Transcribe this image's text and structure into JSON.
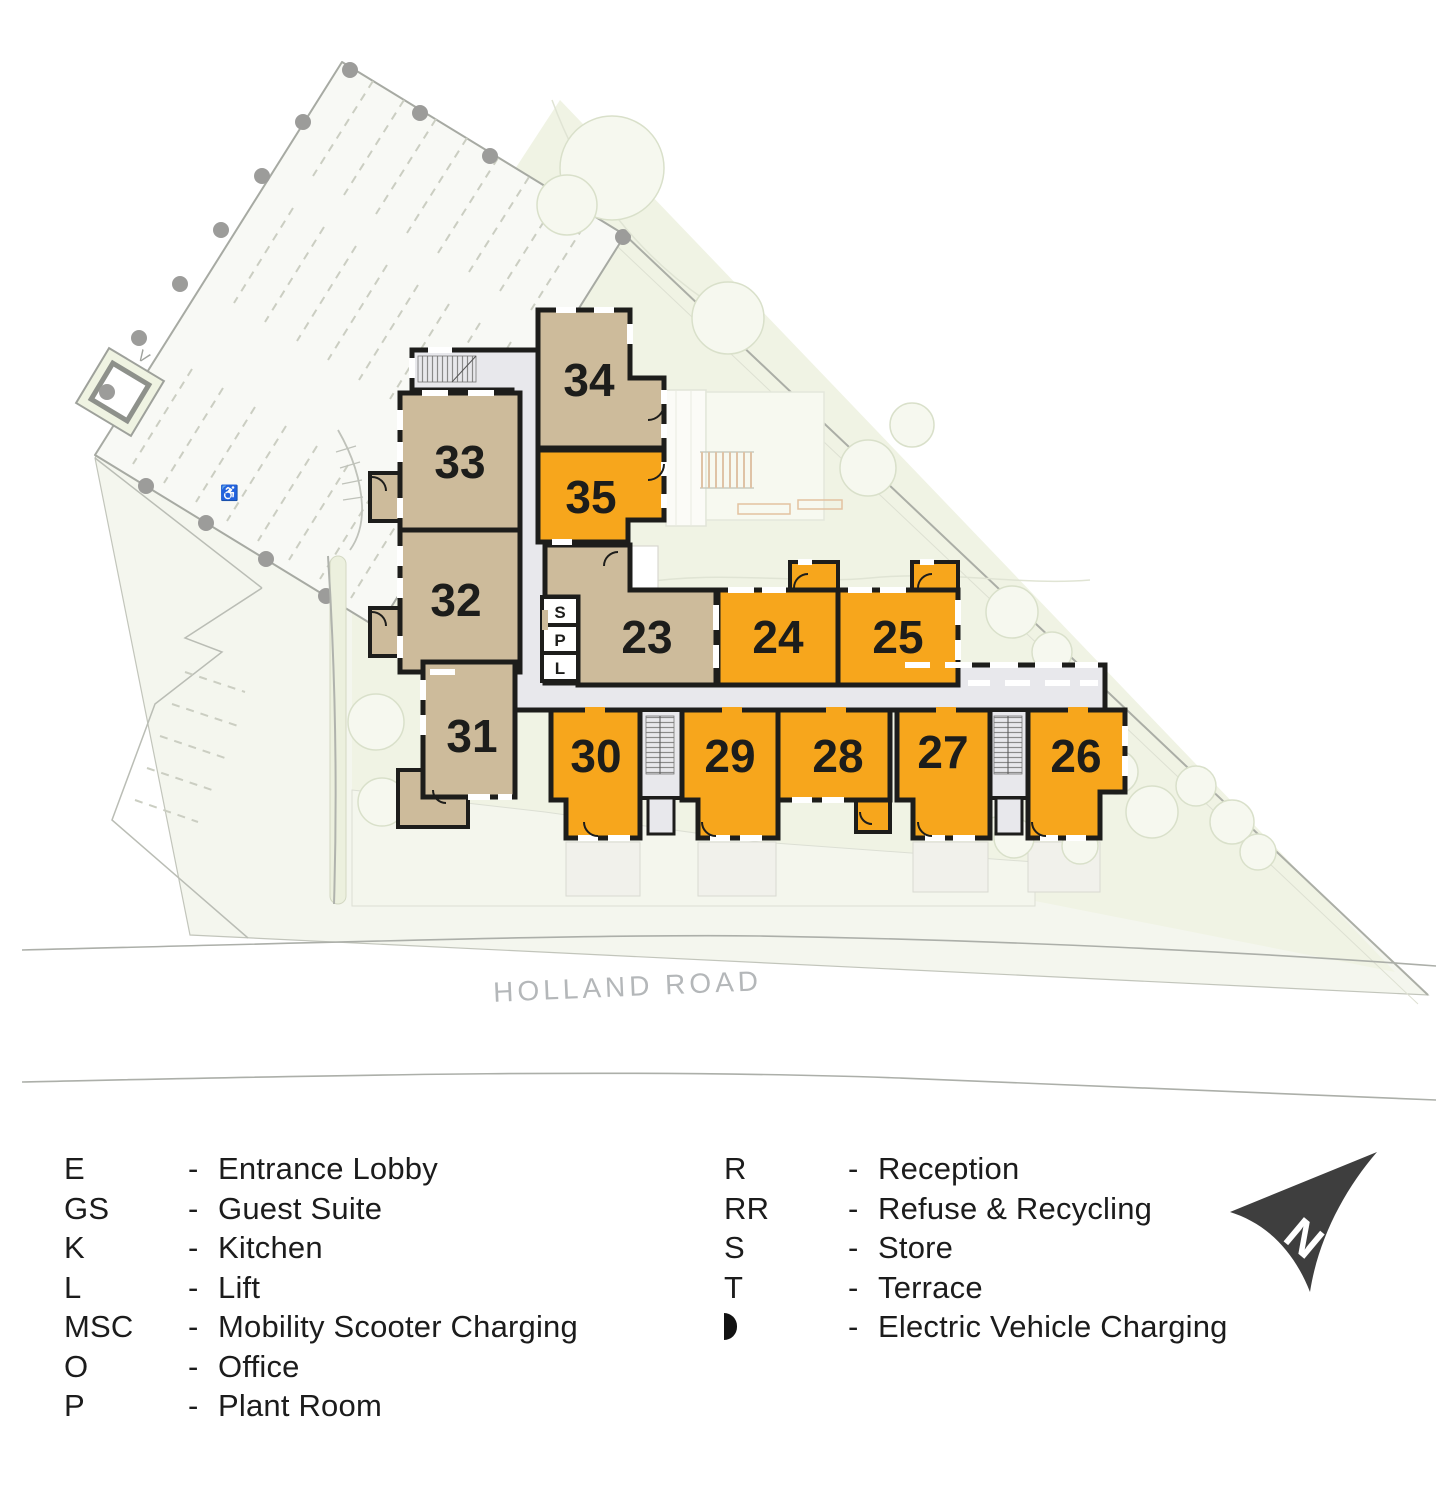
{
  "plan": {
    "road_label": "HOLLAND ROAD",
    "parking_label": "V",
    "accessible_icon": "♿",
    "colors": {
      "highlight": "#F7A61C",
      "standard": "#CDBB9B"
    },
    "units": [
      {
        "number": "23",
        "highlighted": false
      },
      {
        "number": "24",
        "highlighted": true
      },
      {
        "number": "25",
        "highlighted": true
      },
      {
        "number": "26",
        "highlighted": true
      },
      {
        "number": "27",
        "highlighted": true
      },
      {
        "number": "28",
        "highlighted": true
      },
      {
        "number": "29",
        "highlighted": true
      },
      {
        "number": "30",
        "highlighted": true
      },
      {
        "number": "31",
        "highlighted": false
      },
      {
        "number": "32",
        "highlighted": false
      },
      {
        "number": "33",
        "highlighted": false
      },
      {
        "number": "34",
        "highlighted": false
      },
      {
        "number": "35",
        "highlighted": true
      }
    ],
    "core_rooms": [
      {
        "label": "S"
      },
      {
        "label": "P"
      },
      {
        "label": "L"
      }
    ]
  },
  "legend": {
    "separator": "-",
    "left": [
      {
        "abbr": "E",
        "label": "Entrance Lobby"
      },
      {
        "abbr": "GS",
        "label": "Guest Suite"
      },
      {
        "abbr": "K",
        "label": "Kitchen"
      },
      {
        "abbr": "L",
        "label": "Lift"
      },
      {
        "abbr": "MSC",
        "label": "Mobility Scooter Charging"
      },
      {
        "abbr": "O",
        "label": "Office"
      },
      {
        "abbr": "P",
        "label": "Plant Room"
      }
    ],
    "right": [
      {
        "abbr": "R",
        "label": "Reception"
      },
      {
        "abbr": "RR",
        "label": "Refuse & Recycling"
      },
      {
        "abbr": "S",
        "label": "Store"
      },
      {
        "abbr": "T",
        "label": "Terrace"
      },
      {
        "icon": "ev-half-circle",
        "label": "Electric Vehicle Charging"
      }
    ]
  },
  "compass": {
    "label": "N"
  }
}
